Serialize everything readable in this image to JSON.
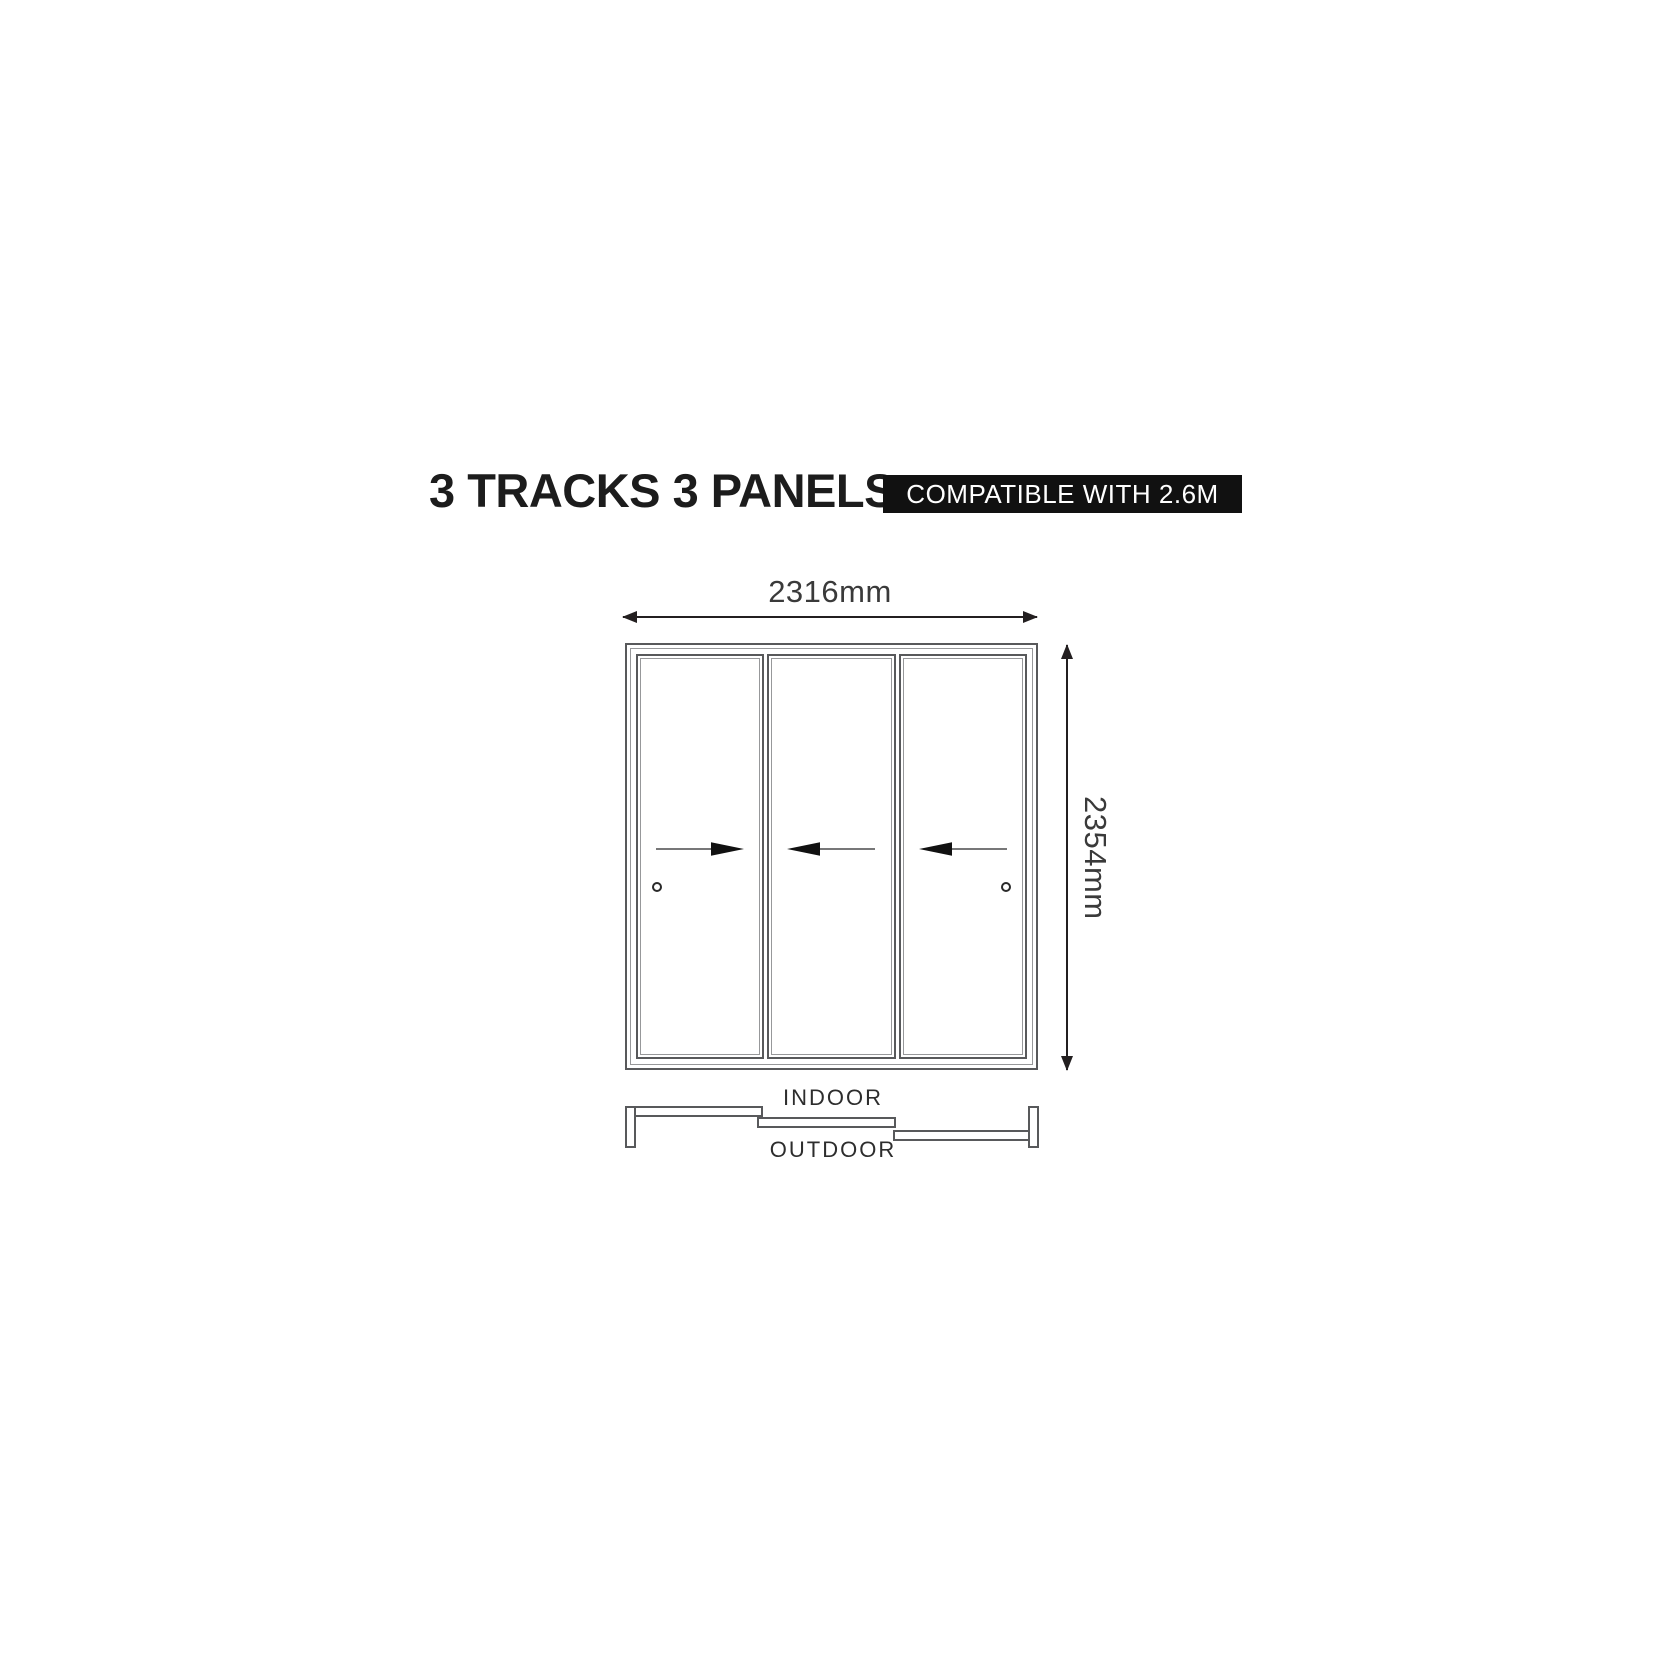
{
  "header": {
    "title": "3 TRACKS 3 PANELS",
    "badge": "COMPATIBLE WITH 2.6M"
  },
  "diagram": {
    "width_label": "2316mm",
    "height_label": "2354mm",
    "indoor_label": "INDOOR",
    "outdoor_label": "OUTDOOR",
    "tracks_count": 3,
    "panels": [
      {
        "name": "panel-1",
        "slide_direction": "right",
        "has_handle": true,
        "handle_side": "left"
      },
      {
        "name": "panel-2",
        "slide_direction": "left",
        "has_handle": false,
        "handle_side": null
      },
      {
        "name": "panel-3",
        "slide_direction": "left",
        "has_handle": true,
        "handle_side": "right"
      }
    ]
  },
  "colors": {
    "badge_bg": "#111111",
    "badge_text": "#ffffff",
    "title_color": "#1c1c1c",
    "frame_line": "#58595b",
    "frame_line_light": "#97989a",
    "dim_line": "#231f20",
    "dim_text": "#3a3a3a",
    "arrow_fill": "#111111"
  }
}
